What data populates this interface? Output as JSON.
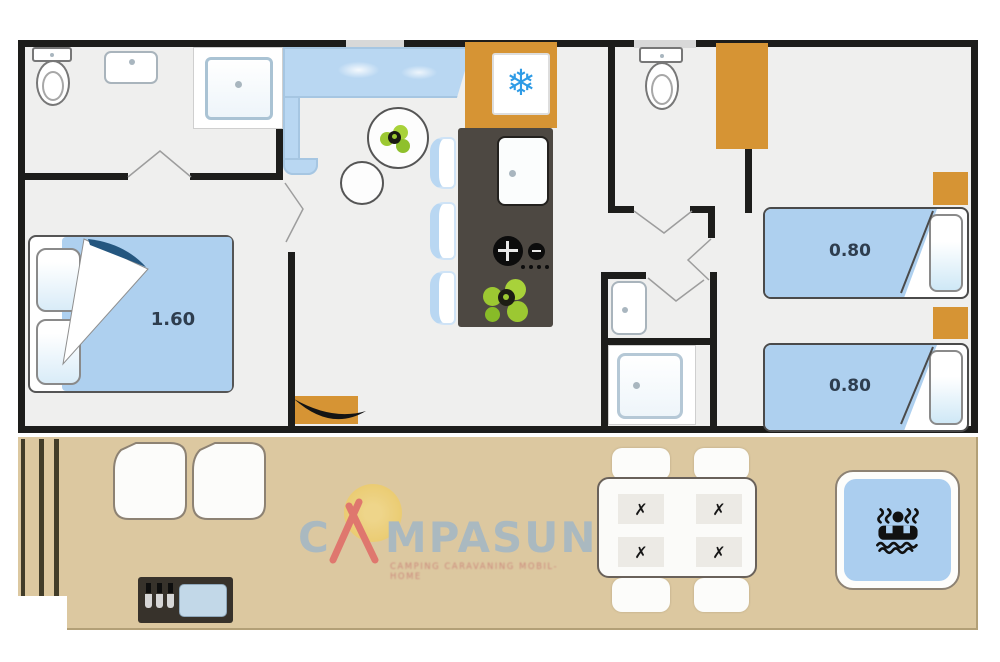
{
  "title": "Mobile home floor plan",
  "floorplan": {
    "labels": {
      "master_bed": "1.60",
      "twin_bed_1": "0.80",
      "twin_bed_2": "0.80"
    }
  },
  "icons": {
    "fridge_snowflake": "❄",
    "cutlery_cross": "✗",
    "jacuzzi": "person-in-whirlpool",
    "entrance_door": "door-swing"
  },
  "logo": {
    "prefix": "C",
    "suffix": "MPASUN",
    "tagline": "CAMPING CARAVANING MOBIL-HOME"
  },
  "colors": {
    "wall": "#1D1D1B",
    "floor": "#EFEFEE",
    "furniture_blue": "#AED0EF",
    "counter_blue": "#B9D7F2",
    "accent_orange": "#D69434",
    "island_dark": "#4D4842",
    "terrace_tan": "#DCC8A0",
    "plant_green": "#9CC832",
    "snowflake_blue": "#2E9BE6",
    "logo_gray_blue": "#A3B8C6",
    "logo_red": "#E06A66",
    "sun_yellow": "#F2CE5E"
  }
}
